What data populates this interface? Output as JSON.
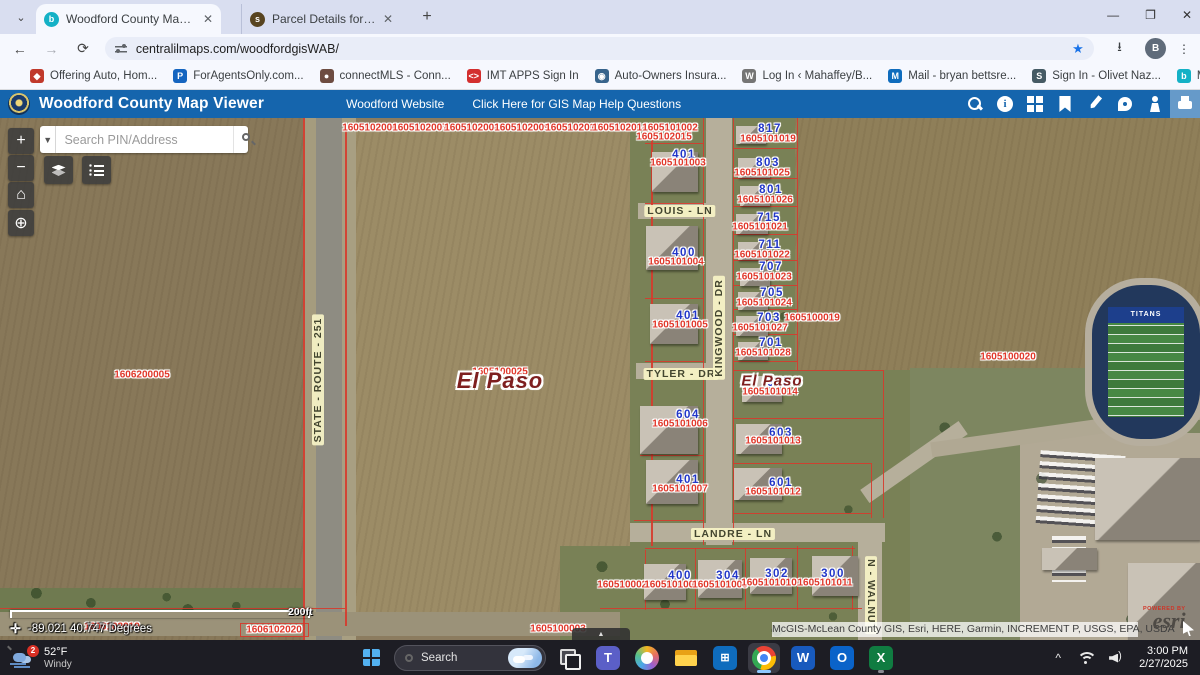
{
  "browser": {
    "tabs": [
      {
        "title": "Woodford County Map Viewer",
        "favicon_color": "#14b1c6",
        "favicon_glyph": "b"
      },
      {
        "title": "Parcel Details for 1605100025",
        "favicon_color": "#584420",
        "favicon_glyph": "s"
      }
    ],
    "url": "centralilmaps.com/woodfordgisWAB/",
    "profile_initial": "B",
    "bookmarks": [
      {
        "label": "Offering Auto, Hom...",
        "glyph": "◆",
        "color": "#c0392b"
      },
      {
        "label": "ForAgentsOnly.com...",
        "glyph": "P",
        "color": "#1565c0"
      },
      {
        "label": "connectMLS - Conn...",
        "glyph": "●",
        "color": "#6d4c41"
      },
      {
        "label": "IMT APPS Sign In",
        "glyph": "<>",
        "color": "#d32f2f"
      },
      {
        "label": "Auto-Owners Insura...",
        "glyph": "◉",
        "color": "#37648c"
      },
      {
        "label": "Log In ‹ Mahaffey/B...",
        "glyph": "W",
        "color": "#757575"
      },
      {
        "label": "Mail - bryan bettsre...",
        "glyph": "M",
        "color": "#0f6cbd"
      },
      {
        "label": "Sign In - Olivet Naz...",
        "glyph": "S",
        "color": "#455a64"
      },
      {
        "label": "McGIS - McLean Co...",
        "glyph": "b",
        "color": "#14b1c6"
      }
    ],
    "more_bookmarks_glyph": "»",
    "all_bookmarks_label": "All Bookmarks"
  },
  "app_header": {
    "title": "Woodford County Map Viewer",
    "links": [
      "Woodford Website",
      "Click Here for GIS Map Help Questions"
    ],
    "header_color": "#1565ad",
    "tools": [
      "search",
      "info",
      "basemap",
      "bookmarks",
      "measure",
      "draw",
      "streetview",
      "print"
    ]
  },
  "map": {
    "search_placeholder": "Search PIN/Address",
    "scale_label": "200ft",
    "coordinates": "-89.021 40.747 Degrees",
    "attribution": "McGIS-McLean County GIS, Esri, HERE, Garmin, INCREMENT P, USGS, EPA, USDA",
    "powered_by": "POWERED BY",
    "esri_logo": "esri",
    "field_team": "TITANS",
    "pin_color": "#e1382b",
    "address_color": "#2136c8",
    "parcel_line_color": "#d63a2c",
    "zones": [
      [
        0,
        0,
        303,
        522,
        "#887859",
        1
      ],
      [
        345,
        6,
        306,
        500,
        "#9c8c66",
        1
      ],
      [
        630,
        0,
        280,
        522,
        "#798156",
        0
      ],
      [
        560,
        428,
        350,
        94,
        "#798156",
        0
      ],
      [
        795,
        0,
        405,
        252,
        "#8f7f59",
        1
      ],
      [
        910,
        250,
        290,
        272,
        "#7d8660",
        0
      ],
      [
        1020,
        315,
        180,
        207,
        "#b2a995",
        0
      ],
      [
        0,
        470,
        303,
        24,
        "#6f7a50",
        0
      ]
    ],
    "roads": [
      [
        303,
        0,
        13,
        522,
        "#a59c7e",
        0
      ],
      [
        342,
        0,
        14,
        522,
        "#a89f82",
        0
      ],
      [
        316,
        0,
        26,
        522,
        "#8e8c82",
        0
      ],
      [
        706,
        0,
        26,
        427,
        "#b6af9b",
        0
      ],
      [
        638,
        85,
        68,
        16,
        "#b6af9b",
        0
      ],
      [
        636,
        245,
        70,
        16,
        "#b6af9b",
        0
      ],
      [
        630,
        405,
        255,
        19,
        "#b6af9b",
        0
      ],
      [
        854,
        336,
        120,
        16,
        "#b6af9b",
        -35
      ],
      [
        930,
        305,
        280,
        15,
        "#b0a893",
        -8
      ],
      [
        858,
        420,
        24,
        102,
        "#b6af9b",
        0
      ],
      [
        0,
        494,
        620,
        24,
        "#9b9279",
        0
      ]
    ],
    "parcel_lines": [
      [
        303,
        0,
        1.5,
        522
      ],
      [
        345,
        8,
        1.5,
        500
      ],
      [
        345,
        8,
        306,
        1.5
      ],
      [
        651,
        8,
        1.5,
        420
      ],
      [
        703,
        0,
        1,
        427
      ],
      [
        733,
        0,
        1,
        427
      ],
      [
        645,
        25,
        58,
        1
      ],
      [
        645,
        85,
        58,
        1
      ],
      [
        645,
        180,
        58,
        1
      ],
      [
        645,
        243,
        58,
        1
      ],
      [
        640,
        337,
        63,
        1
      ],
      [
        634,
        402,
        70,
        1
      ],
      [
        733,
        30,
        64,
        1
      ],
      [
        733,
        60,
        64,
        1
      ],
      [
        733,
        88,
        64,
        1
      ],
      [
        733,
        116,
        64,
        1
      ],
      [
        733,
        142,
        64,
        1
      ],
      [
        733,
        167,
        64,
        1
      ],
      [
        733,
        191,
        64,
        1
      ],
      [
        733,
        216,
        64,
        1
      ],
      [
        733,
        243,
        64,
        1
      ],
      [
        733,
        252,
        150,
        1
      ],
      [
        733,
        300,
        150,
        1
      ],
      [
        733,
        345,
        138,
        1
      ],
      [
        733,
        395,
        138,
        1
      ],
      [
        797,
        0,
        1,
        252
      ],
      [
        883,
        252,
        1,
        148
      ],
      [
        871,
        345,
        1,
        55
      ],
      [
        645,
        432,
        1,
        60
      ],
      [
        695,
        430,
        1,
        62
      ],
      [
        745,
        430,
        1,
        62
      ],
      [
        797,
        428,
        1,
        64
      ],
      [
        852,
        428,
        1,
        64
      ],
      [
        600,
        490,
        262,
        1
      ],
      [
        645,
        430,
        210,
        1
      ],
      [
        0,
        490,
        345,
        1
      ],
      [
        240,
        505,
        1,
        14
      ],
      [
        240,
        505,
        68,
        1
      ],
      [
        308,
        505,
        1,
        14
      ],
      [
        240,
        518,
        68,
        1
      ]
    ],
    "houses": [
      [
        652,
        34,
        46,
        40
      ],
      [
        646,
        108,
        52,
        44
      ],
      [
        650,
        186,
        48,
        40
      ],
      [
        640,
        288,
        58,
        48
      ],
      [
        646,
        342,
        52,
        44
      ],
      [
        736,
        8,
        30,
        18
      ],
      [
        738,
        40,
        32,
        20
      ],
      [
        740,
        68,
        30,
        20
      ],
      [
        736,
        96,
        32,
        20
      ],
      [
        738,
        124,
        30,
        18
      ],
      [
        740,
        150,
        30,
        18
      ],
      [
        738,
        174,
        30,
        18
      ],
      [
        736,
        198,
        32,
        20
      ],
      [
        738,
        224,
        30,
        18
      ],
      [
        742,
        258,
        40,
        26
      ],
      [
        736,
        306,
        46,
        30
      ],
      [
        734,
        350,
        48,
        32
      ],
      [
        644,
        446,
        42,
        36
      ],
      [
        698,
        442,
        44,
        38
      ],
      [
        750,
        440,
        42,
        36
      ],
      [
        812,
        438,
        46,
        40
      ],
      [
        1095,
        340,
        105,
        82
      ],
      [
        1128,
        445,
        72,
        77
      ],
      [
        1042,
        430,
        55,
        22
      ]
    ],
    "pins": [
      [
        "1605102006",
        370,
        10
      ],
      [
        "1605102007",
        420,
        10
      ],
      [
        "1605102008",
        472,
        10
      ],
      [
        "1605102009",
        522,
        10
      ],
      [
        "1605102010",
        573,
        10
      ],
      [
        "1605102014",
        620,
        10
      ],
      [
        "1605101002",
        670,
        10
      ],
      [
        "1605102015",
        664,
        19
      ],
      [
        "1605101003",
        678,
        45
      ],
      [
        "1605101019",
        768,
        21
      ],
      [
        "1605101025",
        762,
        55
      ],
      [
        "1605101026",
        765,
        82
      ],
      [
        "1605101021",
        760,
        109
      ],
      [
        "1605101022",
        762,
        137
      ],
      [
        "1605101023",
        764,
        159
      ],
      [
        "1605101024",
        764,
        185
      ],
      [
        "1605101027",
        760,
        210
      ],
      [
        "1605100019",
        812,
        200
      ],
      [
        "1605101028",
        763,
        235
      ],
      [
        "1605101004",
        676,
        144
      ],
      [
        "1605101005",
        680,
        207
      ],
      [
        "1605101006",
        680,
        306
      ],
      [
        "1605101013",
        773,
        323
      ],
      [
        "1605101007",
        680,
        371
      ],
      [
        "1605101012",
        773,
        374
      ],
      [
        "1605101014",
        770,
        274
      ],
      [
        "1606200005",
        142,
        257
      ],
      [
        "1605100025",
        500,
        254
      ],
      [
        "1605100020",
        1008,
        239
      ],
      [
        "1605100026",
        625,
        467
      ],
      [
        "1605101008",
        672,
        467
      ],
      [
        "1605101009",
        720,
        467
      ],
      [
        "1605101010",
        769,
        465
      ],
      [
        "1605101011",
        825,
        465
      ],
      [
        "1606102019",
        112,
        509
      ],
      [
        "1606102020",
        274,
        512
      ],
      [
        "1605100003",
        558,
        511
      ]
    ],
    "addresses": [
      [
        "817",
        770,
        11
      ],
      [
        "803",
        768,
        45
      ],
      [
        "801",
        771,
        72
      ],
      [
        "715",
        769,
        100
      ],
      [
        "711",
        770,
        127
      ],
      [
        "707",
        771,
        149
      ],
      [
        "705",
        772,
        175
      ],
      [
        "703",
        769,
        200
      ],
      [
        "701",
        771,
        225
      ],
      [
        "401",
        684,
        37
      ],
      [
        "400",
        684,
        135
      ],
      [
        "401",
        688,
        198
      ],
      [
        "604",
        688,
        297
      ],
      [
        "401",
        688,
        362
      ],
      [
        "605",
        779,
        265
      ],
      [
        "603",
        781,
        315
      ],
      [
        "601",
        781,
        365
      ],
      [
        "400",
        680,
        458
      ],
      [
        "304",
        728,
        458
      ],
      [
        "302",
        777,
        456
      ],
      [
        "300",
        833,
        456
      ]
    ],
    "streets": [
      {
        "text": "LOUIS - LN",
        "x": 680,
        "y": 93,
        "rot": 0
      },
      {
        "text": "TYLER - DR",
        "x": 681,
        "y": 256,
        "rot": 0
      },
      {
        "text": "LANDRE - LN",
        "x": 733,
        "y": 416,
        "rot": 0
      },
      {
        "text": "KINGWOOD - DR",
        "x": 719,
        "y": 210,
        "rot": -90
      },
      {
        "text": "STATE - ROUTE - 251",
        "x": 318,
        "y": 262,
        "rot": -90
      },
      {
        "text": "N - WALNUT",
        "x": 871,
        "y": 477,
        "rot": 90
      }
    ],
    "cities": [
      {
        "text": "El Paso",
        "x": 500,
        "y": 263,
        "size": 22
      },
      {
        "text": "El Paso",
        "x": 772,
        "y": 263,
        "size": 15
      }
    ]
  },
  "taskbar": {
    "weather_temp": "52°F",
    "weather_desc": "Windy",
    "weather_badge": "2",
    "search_label": "Search",
    "apps": [
      {
        "name": "task-view",
        "glyph": ""
      },
      {
        "name": "teams",
        "glyph": "T"
      },
      {
        "name": "copilot",
        "glyph": ""
      },
      {
        "name": "explorer",
        "glyph": ""
      },
      {
        "name": "store",
        "glyph": "⊞"
      },
      {
        "name": "chrome",
        "glyph": "",
        "state": "active"
      },
      {
        "name": "word",
        "glyph": "W"
      },
      {
        "name": "outlook",
        "glyph": "O"
      },
      {
        "name": "excel",
        "glyph": "X",
        "state": "open"
      }
    ],
    "time": "3:00 PM",
    "date": "2/27/2025"
  }
}
